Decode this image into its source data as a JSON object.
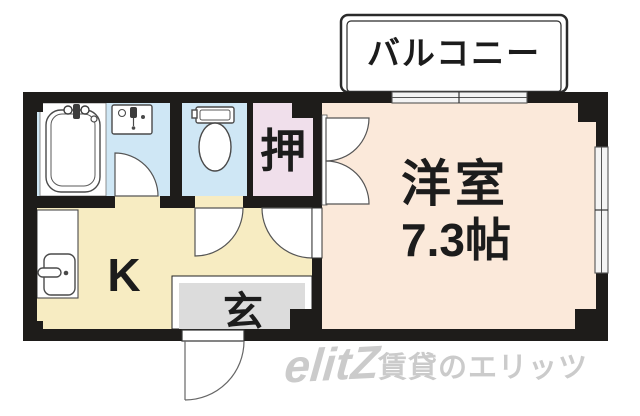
{
  "floorplan": {
    "balcony_label": "バルコニー",
    "living_room": {
      "name": "洋室",
      "size": "7.3帖"
    },
    "closet_label": "押",
    "kitchen_label": "K",
    "entrance_label": "玄",
    "watermark": {
      "logo": "elitZ",
      "text": "賃貸のエリッツ"
    },
    "colors": {
      "wall": "#1e1c1a",
      "living": "#fbe9da",
      "water": "#cfe7f5",
      "closet": "#f0dfeb",
      "kitchen": "#f7ecc2",
      "entrance": "#dcdcdc",
      "watermark": "#cbcbcb"
    }
  }
}
